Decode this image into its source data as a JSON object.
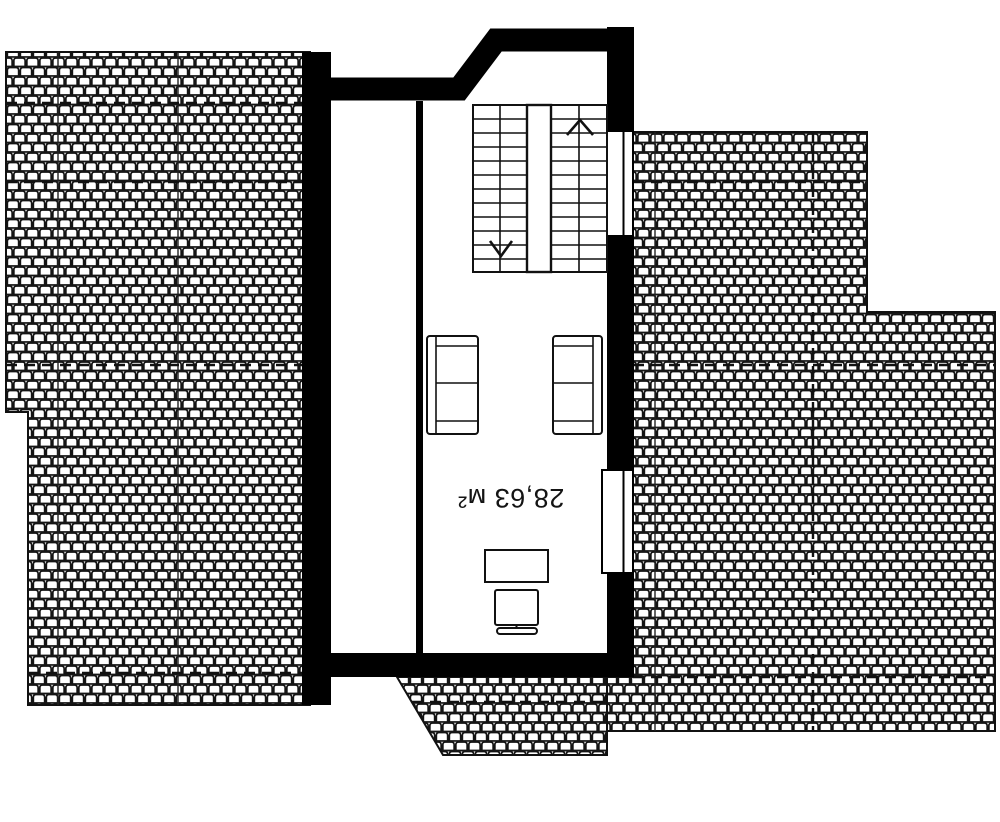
{
  "room": {
    "area_label": "28,63 м²",
    "area_value_m2": "28,63"
  },
  "colors": {
    "wall": "#000000",
    "line": "#141414",
    "background": "#ffffff"
  },
  "icons": {
    "stairs_up_arrow": "chevron-up",
    "stairs_down_arrow": "chevron-down"
  }
}
